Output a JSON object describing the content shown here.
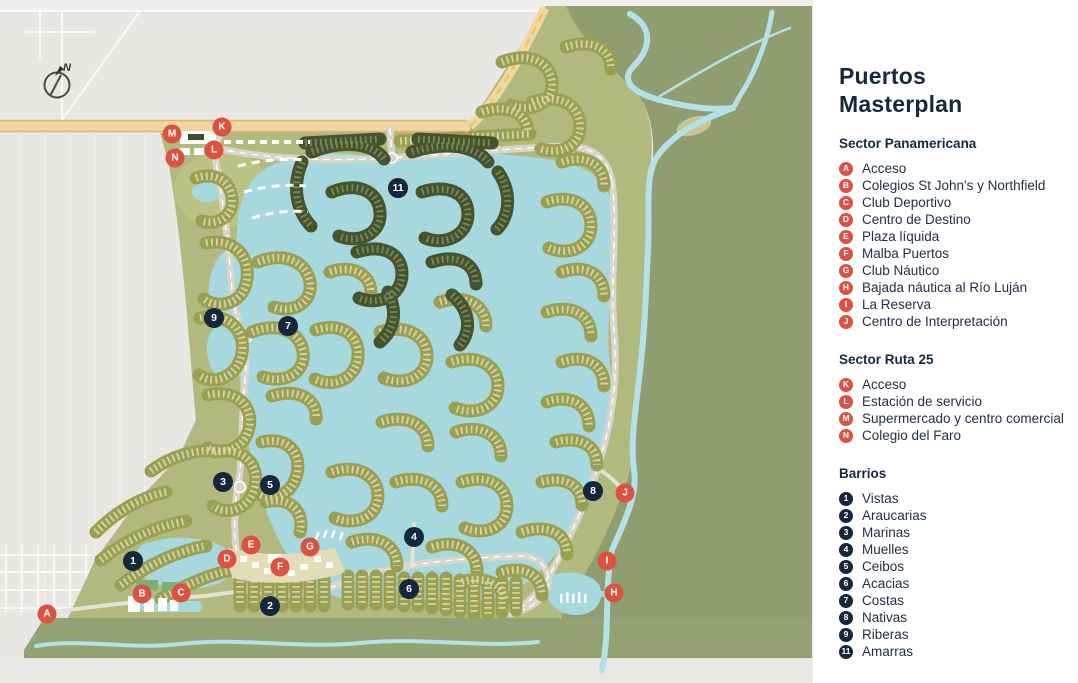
{
  "page": {
    "title": "Puertos Masterplan"
  },
  "panel": {
    "title_lines": [
      "Puertos",
      "Masterplan"
    ],
    "sections": [
      {
        "heading": "Sector Panamericana",
        "marker_type": "letter",
        "items": [
          {
            "id": "A",
            "label": "Acceso"
          },
          {
            "id": "B",
            "label": "Colegios St John's y Northfield"
          },
          {
            "id": "C",
            "label": "Club Deportivo"
          },
          {
            "id": "D",
            "label": "Centro de Destino"
          },
          {
            "id": "E",
            "label": "Plaza líquida"
          },
          {
            "id": "F",
            "label": "Malba Puertos"
          },
          {
            "id": "G",
            "label": "Club Náutico"
          },
          {
            "id": "H",
            "label": "Bajada náutica al Río Luján"
          },
          {
            "id": "I",
            "label": "La Reserva"
          },
          {
            "id": "J",
            "label": "Centro de Interpretación"
          }
        ]
      },
      {
        "heading": "Sector Ruta 25",
        "marker_type": "letter",
        "items": [
          {
            "id": "K",
            "label": "Acceso"
          },
          {
            "id": "L",
            "label": "Estación de servicio"
          },
          {
            "id": "M",
            "label": "Supermercado y centro comercial"
          },
          {
            "id": "N",
            "label": "Colegio del Faro"
          }
        ]
      },
      {
        "heading": "Barrios",
        "marker_type": "number",
        "items": [
          {
            "id": "1",
            "label": "Vistas"
          },
          {
            "id": "2",
            "label": "Araucarias"
          },
          {
            "id": "3",
            "label": "Marinas"
          },
          {
            "id": "4",
            "label": "Muelles"
          },
          {
            "id": "5",
            "label": "Ceibos"
          },
          {
            "id": "6",
            "label": "Acacias"
          },
          {
            "id": "7",
            "label": "Costas"
          },
          {
            "id": "8",
            "label": "Nativas"
          },
          {
            "id": "9",
            "label": "Riberas"
          },
          {
            "id": "11",
            "label": "Amarras"
          }
        ]
      }
    ]
  },
  "map": {
    "compass_label": "N",
    "letter_markers": [
      {
        "id": "A",
        "x": 47,
        "y": 614
      },
      {
        "id": "B",
        "x": 142,
        "y": 594
      },
      {
        "id": "C",
        "x": 181,
        "y": 593
      },
      {
        "id": "D",
        "x": 227,
        "y": 559
      },
      {
        "id": "E",
        "x": 251,
        "y": 545
      },
      {
        "id": "F",
        "x": 280,
        "y": 567
      },
      {
        "id": "G",
        "x": 310,
        "y": 547
      },
      {
        "id": "H",
        "x": 614,
        "y": 593
      },
      {
        "id": "I",
        "x": 607,
        "y": 561
      },
      {
        "id": "J",
        "x": 625,
        "y": 493
      },
      {
        "id": "K",
        "x": 222,
        "y": 127
      },
      {
        "id": "L",
        "x": 214,
        "y": 150
      },
      {
        "id": "M",
        "x": 172,
        "y": 134
      },
      {
        "id": "N",
        "x": 175,
        "y": 158
      }
    ],
    "number_markers": [
      {
        "id": "1",
        "x": 133,
        "y": 561
      },
      {
        "id": "2",
        "x": 270,
        "y": 606
      },
      {
        "id": "3",
        "x": 223,
        "y": 482
      },
      {
        "id": "4",
        "x": 414,
        "y": 537
      },
      {
        "id": "5",
        "x": 270,
        "y": 485
      },
      {
        "id": "6",
        "x": 409,
        "y": 589
      },
      {
        "id": "7",
        "x": 288,
        "y": 326
      },
      {
        "id": "8",
        "x": 593,
        "y": 491
      },
      {
        "id": "9",
        "x": 214,
        "y": 318
      },
      {
        "id": "11",
        "x": 398,
        "y": 188
      }
    ]
  },
  "colors": {
    "letter_marker": "#dc5240",
    "number_marker": "#14273c",
    "lake": "#a7d8dd",
    "river": "#b4e1e8",
    "development_green": "#b1b97f",
    "reserve_green": "#8f9d70",
    "cluster_olive": "#99a054",
    "cluster_dark": "#46532f",
    "highway": "#f0d6a2",
    "title_text": "#16293e"
  }
}
